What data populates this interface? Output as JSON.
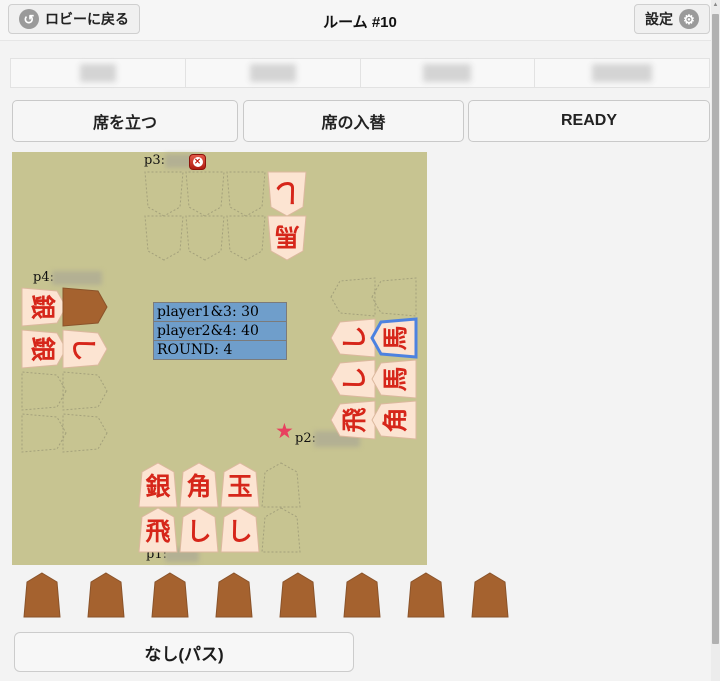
{
  "header": {
    "back_label": "ロビーに戻る",
    "title": "ルーム #10",
    "settings_label": "設定"
  },
  "seats": {
    "count": 4,
    "names_obscured": true
  },
  "actions": {
    "stand_label": "席を立つ",
    "swap_label": "席の入替",
    "ready_label": "READY"
  },
  "board": {
    "score_panel": {
      "rows": [
        "player1&3: 30",
        "player2&4: 40",
        "ROUND: 4"
      ]
    },
    "players": {
      "p1": {
        "label": "p1:",
        "grid": [
          [
            {
              "char": "銀"
            },
            {
              "char": "角"
            },
            {
              "char": "玉"
            },
            null
          ],
          [
            {
              "char": "飛"
            },
            {
              "char": "し"
            },
            {
              "char": "し"
            },
            null
          ]
        ]
      },
      "p2": {
        "label": "p2:",
        "starred": true,
        "grid": [
          [
            null,
            null
          ],
          [
            {
              "char": "し"
            },
            {
              "char": "馬",
              "selected": true
            }
          ],
          [
            {
              "char": "し"
            },
            {
              "char": "馬"
            }
          ],
          [
            {
              "char": "飛"
            },
            {
              "char": "角"
            }
          ]
        ]
      },
      "p3": {
        "label": "p3:",
        "kickable": true,
        "grid": [
          [
            null,
            null,
            null,
            {
              "char": "し"
            }
          ],
          [
            null,
            null,
            null,
            {
              "char": "馬"
            }
          ]
        ]
      },
      "p4": {
        "label": "p4:",
        "grid": [
          [
            {
              "char": "銀"
            },
            {
              "back": true
            }
          ],
          [
            {
              "char": "銀"
            },
            {
              "char": "し"
            }
          ],
          [
            null,
            null
          ],
          [
            null,
            null
          ]
        ]
      }
    }
  },
  "hand": {
    "count": 8,
    "pass_label": "なし(パス)"
  },
  "colors": {
    "board_bg": "#c7c491",
    "piece_face": "#fce4d2",
    "piece_edge": "#dcb89e",
    "piece_text": "#d6261a",
    "piece_back": "#a5622f",
    "piece_back_edge": "#8a532a",
    "slot_outline": "#a3a07b",
    "score_bg": "#6f9ecb",
    "selected_outline": "#4d82e0",
    "star": "#e8415f"
  }
}
